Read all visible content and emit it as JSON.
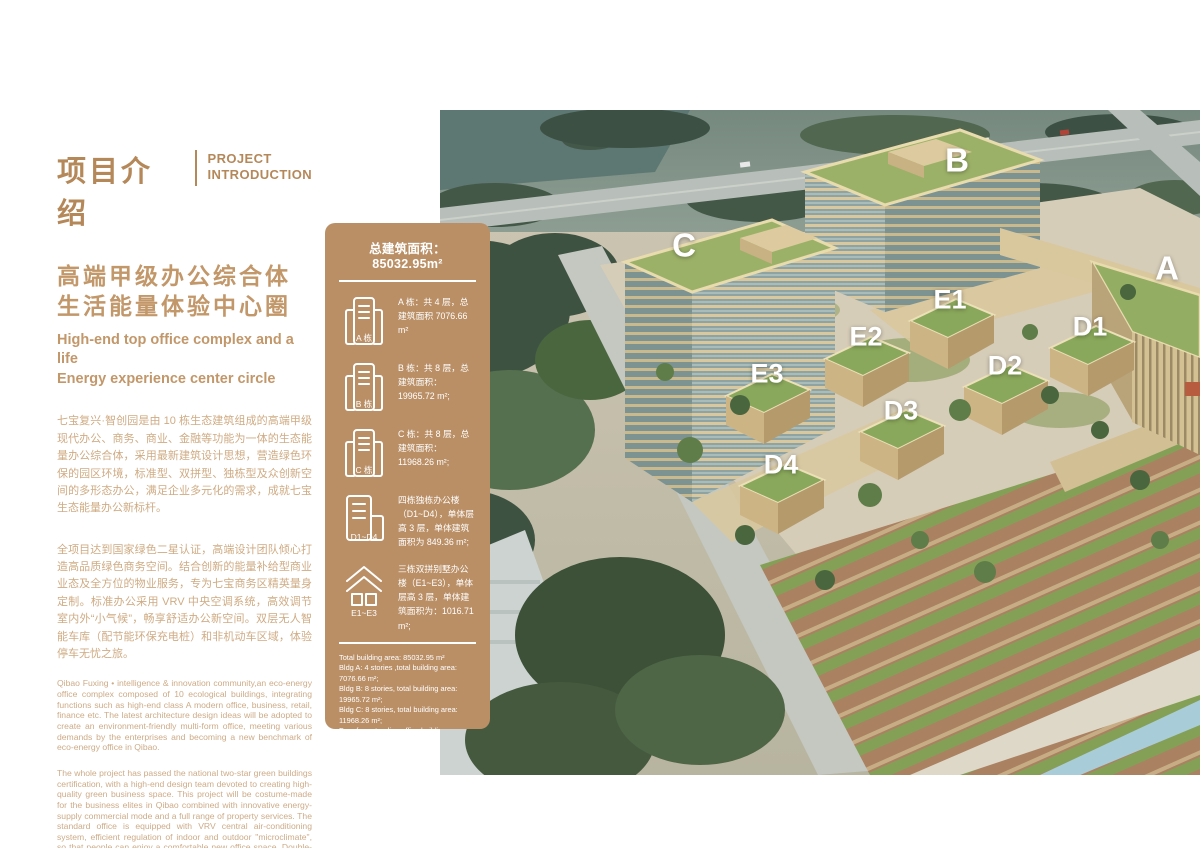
{
  "colors": {
    "accent_brown": "#b5885a",
    "body_text": "#cfab83",
    "panel_bg": "#ba8f66",
    "roof_green": "#9cb168",
    "facade_cream": "#d9c89d"
  },
  "left": {
    "title_zh": "项目介绍",
    "title_en_line1": "PROJECT",
    "title_en_line2": "INTRODUCTION",
    "subtitle_zh_line1": "高端甲级办公综合体",
    "subtitle_zh_line2": "生活能量体验中心圈",
    "subtitle_en_line1": "High-end top office complex and a life",
    "subtitle_en_line2": "Energy experience center circle",
    "para_zh_1": "七宝复兴·智创园是由 10 栋生态建筑组成的高端甲级现代办公、商务、商业、金融等功能为一体的生态能量办公综合体，采用最新建筑设计思想，营造绿色环保的园区环境，标准型、双拼型、独栋型及众创新空间的多形态办公，满足企业多元化的需求，成就七宝生态能量办公新标杆。",
    "para_zh_2": "全项目达到国家绿色二星认证，高端设计团队倾心打造高品质绿色商务空间。结合创新的能量补给型商业业态及全方位的物业服务，专为七宝商务区精英量身定制。标准办公采用 VRV 中央空调系统，高效调节室内外“小气候”，畅享舒适办公新空间。双层无人智能车库（配节能环保充电桩）和非机动车区域，体验停车无忧之旅。",
    "para_en_1": "Qibao Fuxing • intelligence & innovation community,an eco-energy office complex composed of 10 ecological buildings, integrating functions such as high-end class A modern office, business, retail, finance etc. The latest architecture design ideas will be adopted to create an environment-friendly multi-form office, meeting various demands by the enterprises and becoming a new benchmark of eco-energy office in Qibao.",
    "para_en_2": "The whole project has passed the national two-star green buildings certification, with a high-end design team devoted to creating high-quality green business space. This project will be costume-made for the business elites in Qibao combined with innovative energy-supply commercial mode and a full range of property services. The standard office is equipped with VRV central air-conditioning system, efficient regulation of indoor and outdoor \"microclimate\", so that people can enjoy a comfortable new office space. Double-decker Intelligent Garage (with energy-saving and environmentally-friendly charging pile) and non-motor vehicle area will provide trouble-free parking experience."
  },
  "panel": {
    "header": "总建筑面积：85032.95m²",
    "items": [
      {
        "icon": "tower-icon",
        "label": "A 栋",
        "text": "A 栋：共 4 层，总建筑面积 7076.66 m²"
      },
      {
        "icon": "tower-icon",
        "label": "B 栋",
        "text": "B 栋：共 8 层，总建筑面积：19965.72 m²;"
      },
      {
        "icon": "tower-icon",
        "label": "C 栋",
        "text": "C 栋：共 8 层，总建筑面积：11968.26 m²;"
      },
      {
        "icon": "twin-building-icon",
        "label": "D1~D4",
        "text": "四栋独栋办公楼（D1~D4），单体层高 3 层，单体建筑面积为 849.36 m²;"
      },
      {
        "icon": "villa-icon",
        "label": "E1~E3",
        "text": "三栋双拼别墅办公楼（E1~E3），单体层高 3 层，单体建筑面积为：1016.71 m²;"
      }
    ],
    "footer_lines": [
      "Total building area: 85032.95 m²",
      "Bldg A: 4 stories ,total building area: 7076.66 m²;",
      "Bldg B: 8 stories, total building area: 19965.72 m²;",
      "Bldg C: 8 stories, total building area: 11968.26 m²;",
      "Four free-standing office buildings (D1~D4), each building has three stories, with the GFA being 849.36 m² each;",
      "Three environment-friendly office building (E1~E3), each building has three stories, with the GFA being 1016.71 m² each;"
    ]
  },
  "rendering": {
    "labels": [
      {
        "text": "B"
      },
      {
        "text": "C"
      },
      {
        "text": "A"
      },
      {
        "text": "E1"
      },
      {
        "text": "E2"
      },
      {
        "text": "E3"
      },
      {
        "text": "D1"
      },
      {
        "text": "D2"
      },
      {
        "text": "D3"
      },
      {
        "text": "D4"
      }
    ]
  }
}
